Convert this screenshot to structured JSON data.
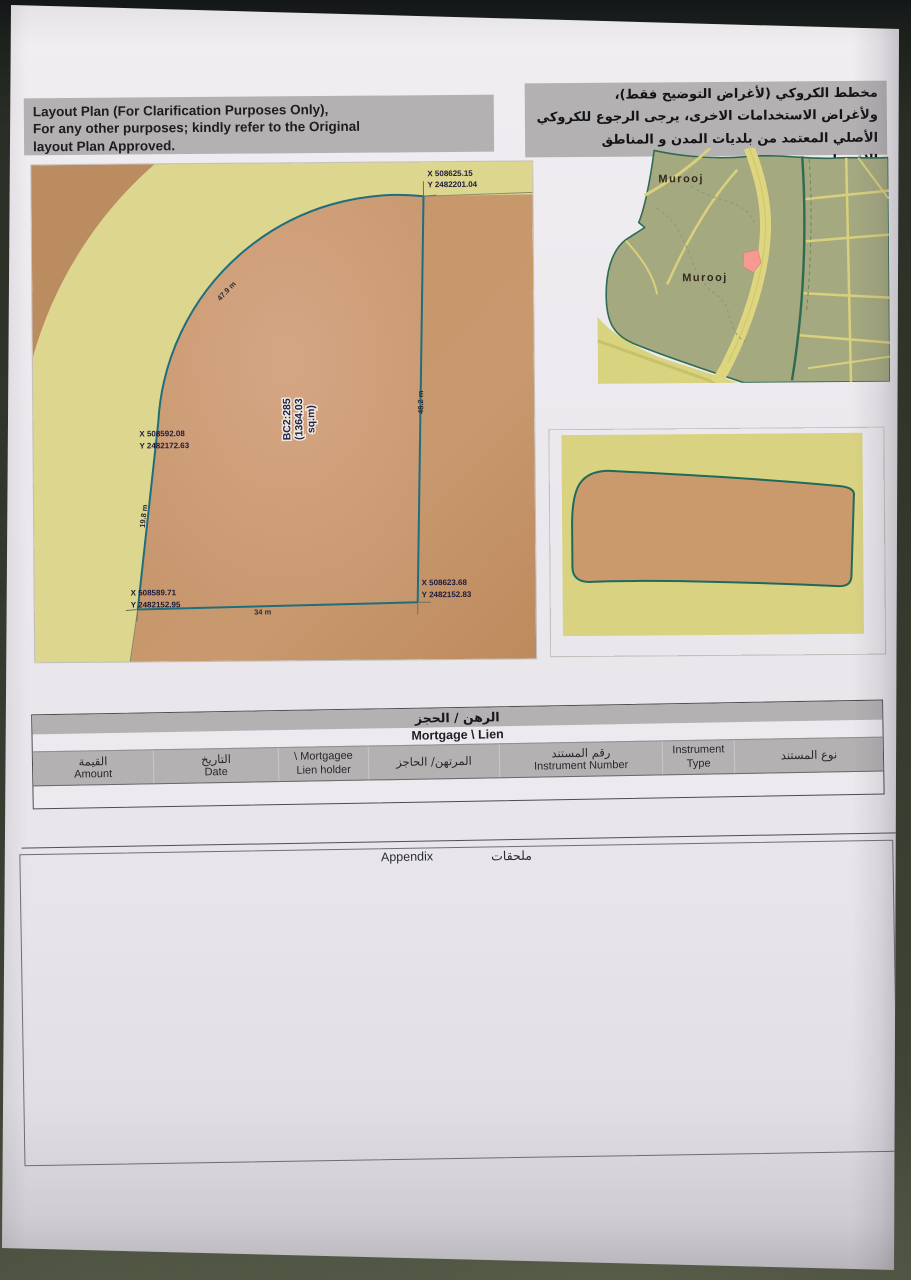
{
  "header": {
    "english": {
      "line1": "Layout Plan (For Clarification Purposes Only),",
      "line2": "For any other purposes; kindly refer to the Original",
      "line3": "layout Plan Approved."
    },
    "arabic": {
      "line1": "مخطط الكروكي (لأغراض التوضيح فقط)،",
      "line2": "ولأغراض الاستخدامات الاخرى، يرجى الرجوع للكروكي",
      "line3": "الأصلي المعتمد من بلديات المدن و المناطق الاقتصادية."
    }
  },
  "plot": {
    "parcel_label": {
      "line1": "BC2:285",
      "line2": "(1364.03",
      "line3": "sq.m)"
    },
    "corners": {
      "top_right": {
        "x": "X 508625.15",
        "y": "Y 2482201.04"
      },
      "mid_left": {
        "x": "X 508592.08",
        "y": "Y 2482172.63"
      },
      "bottom_left": {
        "x": "X 508589.71",
        "y": "Y 2482152.95"
      },
      "bottom_right": {
        "x": "X 508623.68",
        "y": "Y 2482152.83"
      }
    },
    "dimensions": {
      "arc": "47.9 m",
      "right": "48.2 m",
      "bottom": "34 m",
      "left": "19.8 m"
    }
  },
  "overview_map": {
    "labels": {
      "district_top": "Murooj",
      "district_center": "Murooj"
    }
  },
  "mortgage_table": {
    "title_ar": "الرهن / الحجز",
    "title_en": "Mortgage \\ Lien",
    "columns": [
      {
        "line1": "القيمة",
        "line2": "Amount"
      },
      {
        "line1": "التاريخ",
        "line2": "Date"
      },
      {
        "line1": "\\ Mortgagee",
        "line2": "Lien holder"
      },
      {
        "line1": "المرتهن/ الحاجز",
        "line2": ""
      },
      {
        "line1": "رقم المستند",
        "line2": "Instrument Number"
      },
      {
        "line1": "Instrument",
        "line2": "Type"
      },
      {
        "line1": "نوع المستند",
        "line2": ""
      }
    ]
  },
  "appendix": {
    "label_en": "Appendix",
    "label_ar": "ملحقات"
  },
  "colors": {
    "parcel_outline": "#1e6e7d",
    "parcel_fill": "#cd9d76",
    "road_band": "#dcd68f",
    "map_land": "#a4a980",
    "map_road": "#ded67f",
    "map_highlight": "#f49a92",
    "header_bg": "#b3b1b2"
  }
}
